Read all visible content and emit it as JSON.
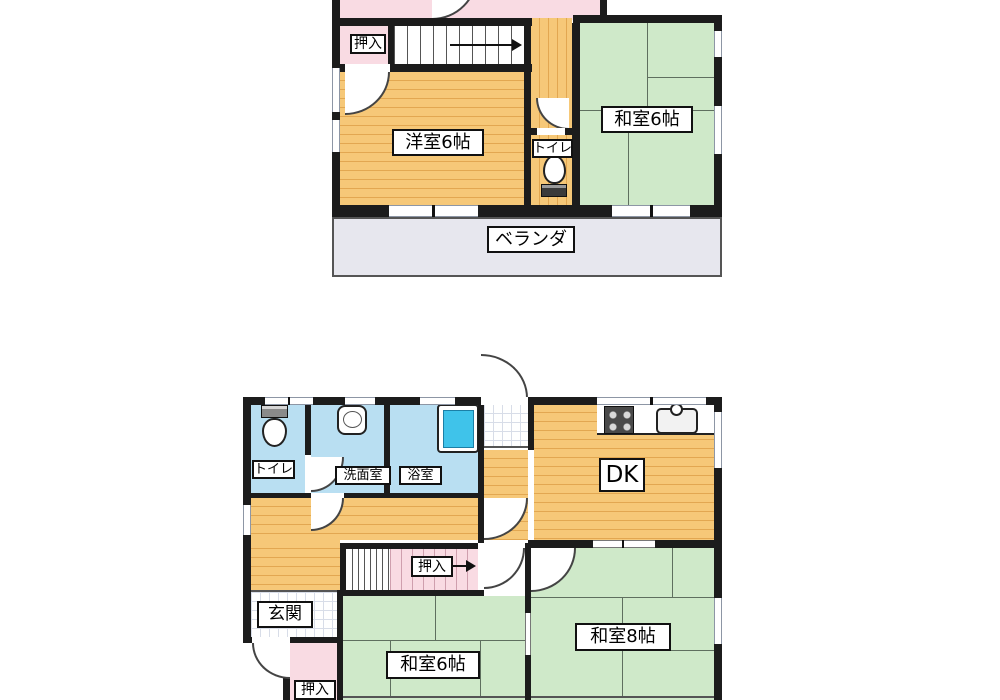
{
  "title": "Two-storey Japanese house floor plan",
  "colors": {
    "wall": "#1c1c1c",
    "wood_floor": "#f6c878",
    "wood_floor_stripe": "#e2a751",
    "tatami_green": "#cfe9c9",
    "tatami_line": "#5f6f5f",
    "closet_pink": "#f9dbe3",
    "wet_room_blue": "#b9dff2",
    "bathtub_blue": "#3fc3ea",
    "veranda_gray": "#e7e7ee"
  },
  "upper_floor": {
    "rooms": [
      {
        "id": "oshiire",
        "label": "押入"
      },
      {
        "id": "western_room",
        "label": "洋室6帖"
      },
      {
        "id": "japanese_room",
        "label": "和室6帖"
      },
      {
        "id": "toilet",
        "label": "トイレ"
      },
      {
        "id": "veranda",
        "label": "ベランダ"
      }
    ]
  },
  "lower_floor": {
    "rooms": [
      {
        "id": "toilet",
        "label": "トイレ"
      },
      {
        "id": "washroom",
        "label": "洗面室"
      },
      {
        "id": "bathroom",
        "label": "浴室"
      },
      {
        "id": "dining_kitchen",
        "label": "DK"
      },
      {
        "id": "entrance",
        "label": "玄関"
      },
      {
        "id": "stair_closet",
        "label": "押入"
      },
      {
        "id": "entry_closet",
        "label": "押入"
      },
      {
        "id": "japanese_room_6",
        "label": "和室6帖"
      },
      {
        "id": "japanese_room_8",
        "label": "和室8帖"
      }
    ]
  },
  "icons": {
    "toilet": "toilet-icon",
    "wash_basin": "sink-icon",
    "bathtub": "bathtub-icon",
    "gas_stove": "stove-icon",
    "kitchen_sink": "kitchen-sink-icon",
    "stair_direction": "arrow-right-icon"
  }
}
